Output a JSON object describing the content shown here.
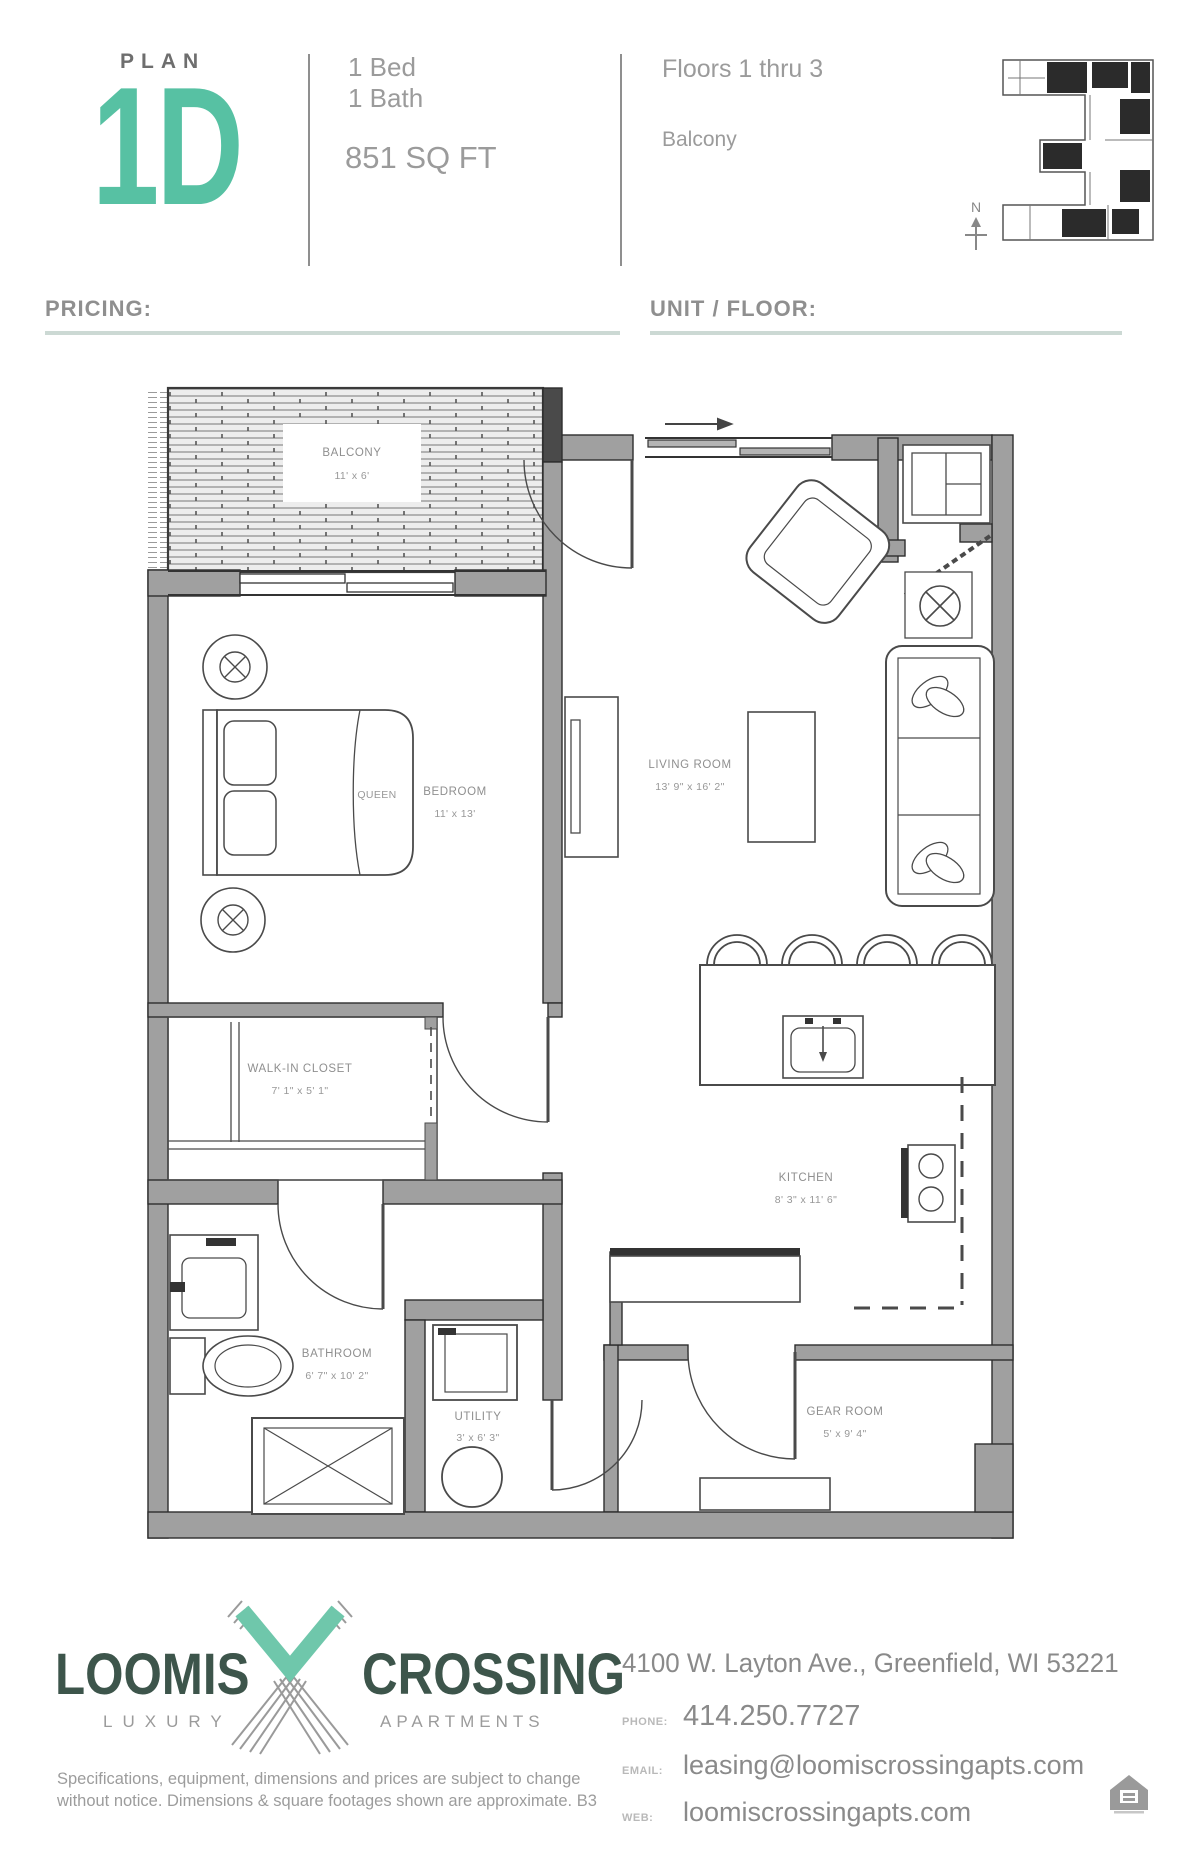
{
  "header": {
    "plan_label": "PLAN",
    "plan_code": "1D",
    "bed": "1 Bed",
    "bath": "1 Bath",
    "sqft": "851 SQ FT",
    "floors": "Floors 1 thru 3",
    "feature": "Balcony",
    "compass": "N"
  },
  "fields": {
    "pricing_label": "PRICING:",
    "unit_floor_label": "UNIT / FLOOR:"
  },
  "floorplan": {
    "rooms": [
      {
        "name": "BALCONY",
        "dims": "11' x 6'"
      },
      {
        "name": "BEDROOM",
        "dims": "11' x 13'"
      },
      {
        "name": "LIVING ROOM",
        "dims": "13' 9\" x 16' 2\""
      },
      {
        "name": "WALK-IN CLOSET",
        "dims": "7' 1\" x 5' 1\""
      },
      {
        "name": "BATHROOM",
        "dims": "6' 7\" x 10' 2\""
      },
      {
        "name": "UTILITY",
        "dims": "3' x 6' 3\""
      },
      {
        "name": "KITCHEN",
        "dims": "8' 3\" x 11' 6\""
      },
      {
        "name": "GEAR ROOM",
        "dims": "5' x 9' 4\""
      }
    ],
    "furniture": {
      "bed_label": "QUEEN"
    }
  },
  "footer": {
    "logo": {
      "name1": "LOOMIS",
      "name2": "CROSSING",
      "sub1": "LUXURY",
      "sub2": "APARTMENTS"
    },
    "disclaimer_line1": "Specifications, equipment, dimensions and prices are subject to change",
    "disclaimer_line2": "without notice. Dimensions & square footages shown are approximate. B3",
    "address": "4100 W. Layton Ave., Greenfield, WI 53221",
    "phone_label": "PHONE:",
    "phone": "414.250.7727",
    "email_label": "EMAIL:",
    "email": "leasing@loomiscrossingapts.com",
    "web_label": "WEB:",
    "web": "loomiscrossingapts.com"
  },
  "colors": {
    "accent": "#57c1a3",
    "logo_dark": "#3d554b",
    "wall_gray": "#a0a0a0",
    "text_gray": "#8f8f8f",
    "underline": "#ccd9d4"
  }
}
